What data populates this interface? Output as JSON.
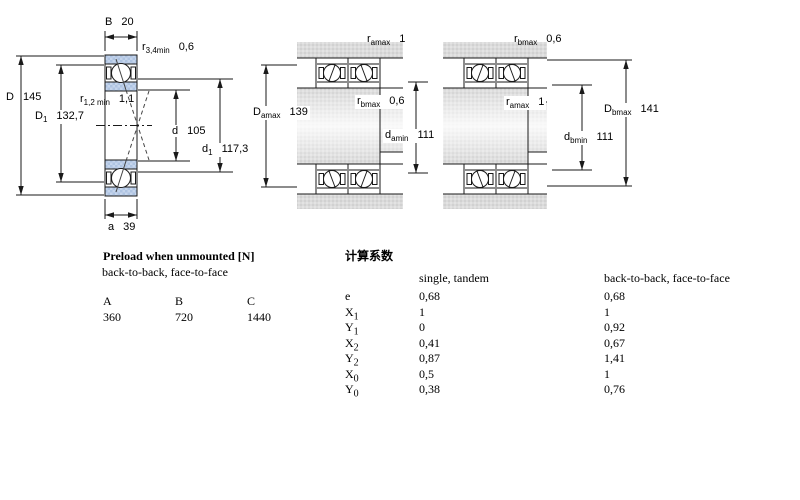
{
  "diagrams": {
    "left": {
      "B": {
        "base": "B",
        "sub": "",
        "value": "20"
      },
      "r34": {
        "base": "r",
        "sub": "3,4min",
        "value": "0,6"
      },
      "D": {
        "base": "D",
        "sub": "",
        "value": "145"
      },
      "r12": {
        "base": "r",
        "sub": "1,2 min",
        "value": "1,1"
      },
      "D1": {
        "base": "D",
        "sub": "1",
        "value": "132,7"
      },
      "d": {
        "base": "d",
        "sub": "",
        "value": "105"
      },
      "d1": {
        "base": "d",
        "sub": "1",
        "value": "117,3"
      },
      "a": {
        "base": "a",
        "sub": "",
        "value": "39"
      }
    },
    "middle": {
      "ra": {
        "base": "r",
        "sub": "amax",
        "value": "1"
      },
      "rb": {
        "base": "r",
        "sub": "bmax",
        "value": "0,6"
      },
      "Da": {
        "base": "D",
        "sub": "amax",
        "value": "139"
      },
      "da": {
        "base": "d",
        "sub": "amin",
        "value": "111"
      }
    },
    "right": {
      "rb": {
        "base": "r",
        "sub": "bmax",
        "value": "0,6"
      },
      "ra": {
        "base": "r",
        "sub": "amax",
        "value": "1"
      },
      "Db": {
        "base": "D",
        "sub": "bmax",
        "value": "141"
      },
      "db": {
        "base": "d",
        "sub": "bmin",
        "value": "111"
      }
    }
  },
  "preload_table": {
    "title": "Preload when unmounted [N]",
    "subtitle": "back-to-back, face-to-face",
    "columns": [
      "A",
      "B",
      "C"
    ],
    "values": [
      "360",
      "720",
      "1440"
    ]
  },
  "factors_table": {
    "title": "计算系数",
    "col1": "single, tandem",
    "col2": "back-to-back, face-to-face",
    "rows": [
      {
        "base": "e",
        "sub": "",
        "v1": "0,68",
        "v2": "0,68"
      },
      {
        "base": "X",
        "sub": "1",
        "v1": "1",
        "v2": "1"
      },
      {
        "base": "Y",
        "sub": "1",
        "v1": "0",
        "v2": "0,92"
      },
      {
        "base": "X",
        "sub": "2",
        "v1": "0,41",
        "v2": "0,67"
      },
      {
        "base": "Y",
        "sub": "2",
        "v1": "0,87",
        "v2": "1,41"
      },
      {
        "base": "X",
        "sub": "0",
        "v1": "0,5",
        "v2": "1"
      },
      {
        "base": "Y",
        "sub": "0",
        "v1": "0,38",
        "v2": "0,76"
      }
    ]
  },
  "colors": {
    "ring_blue": "#b3c8e4",
    "gray_band": "#d8d8d8",
    "line": "#1a1a1a"
  }
}
